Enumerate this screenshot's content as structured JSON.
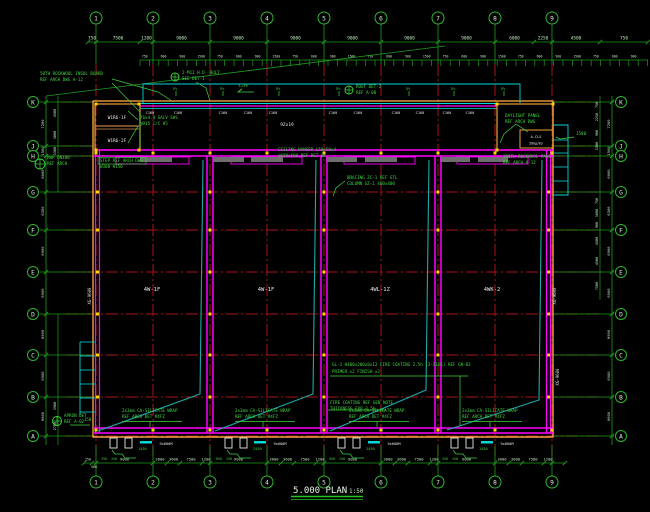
{
  "title": {
    "text": "5.000 PLAN",
    "scale": "1:50"
  },
  "grid": {
    "cols": [
      "1",
      "2",
      "3",
      "4",
      "5",
      "6",
      "7",
      "8",
      "9"
    ],
    "rows": [
      "K",
      "J",
      "H",
      "G",
      "F",
      "E",
      "D",
      "C",
      "B",
      "A"
    ]
  },
  "dims": {
    "top_row1": [
      "750",
      "7500",
      "1200",
      "9000",
      "9000",
      "9000",
      "9000",
      "9000",
      "9000",
      "6000",
      "2250",
      "4500",
      "750"
    ],
    "top_row2_cycle": [
      "750",
      "2400",
      "600",
      "2400",
      "900",
      "3000",
      "1500",
      "600"
    ],
    "bottom_module": [
      "9000",
      "3600",
      "3600",
      "7500",
      "1200"
    ],
    "bottom_left_extra": [
      "250",
      "500"
    ],
    "left_outer": [
      "7200",
      "1500",
      "6000",
      "6300",
      "6900",
      "6900",
      "6900",
      "6900",
      "6600"
    ],
    "right_outer": [
      "7200",
      "1500",
      "6000",
      "6300",
      "6900",
      "6900",
      "6900",
      "6900",
      "6600"
    ],
    "left_inner": [
      {
        "y": 113,
        "v": "4500"
      },
      {
        "y": 135,
        "v": "3000"
      },
      {
        "y": 151,
        "v": "1500"
      },
      {
        "y": 406,
        "v": "3900"
      },
      {
        "y": 426,
        "v": "2700"
      }
    ],
    "right_inner": [
      {
        "y": 105,
        "v": "750"
      },
      {
        "y": 117,
        "v": "2250"
      },
      {
        "y": 133,
        "v": "900"
      },
      {
        "y": 146,
        "v": "1500"
      },
      {
        "y": 201,
        "v": "750"
      },
      {
        "y": 213,
        "v": "3600"
      },
      {
        "y": 225,
        "v": "900"
      },
      {
        "y": 241,
        "v": "4500"
      },
      {
        "y": 261,
        "v": "4500"
      },
      {
        "y": 286,
        "v": "7500"
      }
    ]
  },
  "bays": {
    "labels": [
      "4W-1F",
      "4W-1F",
      "4WL-1Z",
      "4WK-2"
    ],
    "door_label": "9x600M"
  },
  "purlin_label": "C160",
  "strip_label": "9Zx19",
  "wall_labels": [
    "XG-9600",
    "XG-9600",
    "XG-9600"
  ],
  "corner_box": {
    "left": [
      "W1R6-1F",
      "W1R6-2F"
    ],
    "right_inner": [
      "A-CLS",
      "50kg/m3"
    ]
  },
  "slope": {
    "mark": "5%",
    "main": "i=5%"
  },
  "annotations": {
    "a1": [
      "50TH ROCKWOOL INSUL BOARD",
      "REF ARCH DWG A-12"
    ],
    "a2": [
      "2-M12 H.D. BOLT",
      "SEE DET-1"
    ],
    "a3": [
      "ROOF DET-2",
      "REF A-08"
    ],
    "a4": [
      "DAYLIGHT PANEL",
      "REF ARCH DWG"
    ],
    "a5": [
      "1500"
    ],
    "a6": [
      "76x4.0 GALV SHS",
      "@915 C/C H5"
    ],
    "a7": [
      "CEILING HANGER L50x50x4",
      "@600x600 REF DET-07"
    ],
    "a8": [
      "100TH ROCKWOOL PANEL",
      "REF ARCH A-12"
    ],
    "a9": [
      "STEP REF ARCH DWG",
      "W300 H150"
    ],
    "a10": [
      "BRACING ZC-1 REF STL",
      "COLUMN GZ-1 400x400"
    ],
    "a12": [
      "GL-1 H400x200x8x12 FIRE COATING 2.5h (3-SIDE) REF GN-03",
      "PRIMER x2 FINISH x2"
    ],
    "a13": [
      "FIRE COATING REF GEN NOTE",
      "THICKNESS FOR 2.5h"
    ],
    "a14": [
      "2x3mm CA-SILICATE WRAP",
      "REF ARCH DET #4FZ"
    ],
    "a15": [
      "APRON DET",
      "REF A-02",
      "150"
    ],
    "a16": [
      "RWP DN100",
      "REF ARCH"
    ],
    "door_dims": [
      [
        "250",
        "250",
        "1450"
      ],
      [
        "850",
        "250",
        "2450"
      ],
      [
        "850",
        "250",
        "2450"
      ],
      [
        "250",
        "250",
        "1450"
      ]
    ]
  },
  "colors": {
    "background": "#000000",
    "grid_red": "#A81414",
    "dim_green": "#1E9E1E",
    "annotation_green": "#3FD43F",
    "wall_magenta": "#FF00FF",
    "outline_orange": "#F09E3C",
    "divider_tan": "#A0693A",
    "brace_cyan": "#1FA8A8",
    "detail_cyan": "#00D8D8",
    "node_yellow": "#FFD500",
    "text_white": "#E6E6E6",
    "dim_text": "#BDE8BD",
    "bubble_text": "#D8F0D8",
    "opening_gray": "#6E6E6E"
  }
}
